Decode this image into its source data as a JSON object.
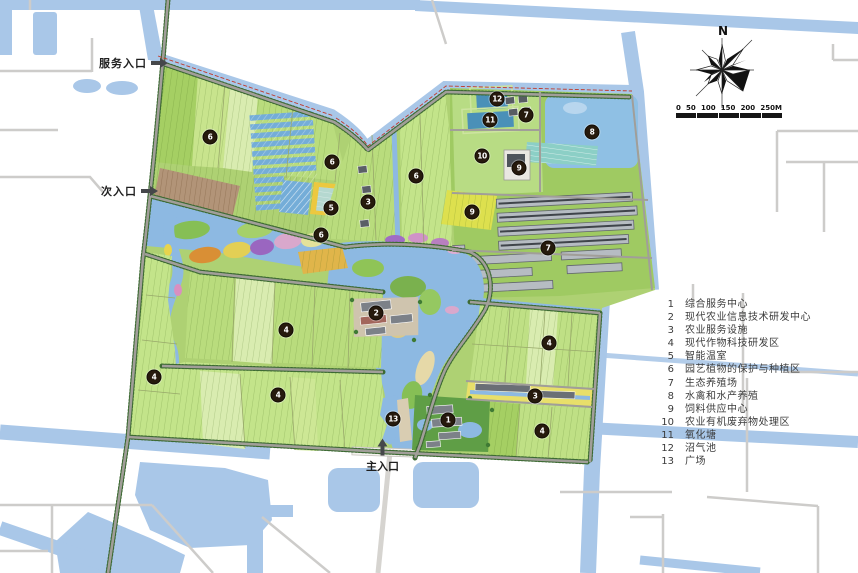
{
  "entrances": {
    "service": {
      "label": "服务入口"
    },
    "secondary": {
      "label": "次入口"
    },
    "main": {
      "label": "主入口"
    }
  },
  "compass": {
    "north_label": "N"
  },
  "scale_bar": {
    "labels": [
      "0",
      "50",
      "100",
      "150",
      "200",
      "250M"
    ]
  },
  "legend": {
    "items": [
      {
        "no": "1",
        "label": "综合服务中心"
      },
      {
        "no": "2",
        "label": "现代农业信息技术研发中心"
      },
      {
        "no": "3",
        "label": "农业服务设施"
      },
      {
        "no": "4",
        "label": "现代作物科技研发区"
      },
      {
        "no": "5",
        "label": "智能温室"
      },
      {
        "no": "6",
        "label": "园艺植物的保护与种植区"
      },
      {
        "no": "7",
        "label": "生态养殖场"
      },
      {
        "no": "8",
        "label": "水禽和水产养殖"
      },
      {
        "no": "9",
        "label": "饲料供应中心"
      },
      {
        "no": "10",
        "label": "农业有机废弃物处理区"
      },
      {
        "no": "11",
        "label": "氧化塘"
      },
      {
        "no": "12",
        "label": "沼气池"
      },
      {
        "no": "13",
        "label": "广场"
      }
    ]
  },
  "map": {
    "markers": [
      {
        "n": "6",
        "x": 210,
        "y": 137
      },
      {
        "n": "6",
        "x": 332,
        "y": 162
      },
      {
        "n": "6",
        "x": 416,
        "y": 176
      },
      {
        "n": "3",
        "x": 368,
        "y": 202
      },
      {
        "n": "5",
        "x": 331,
        "y": 208
      },
      {
        "n": "6",
        "x": 321,
        "y": 235
      },
      {
        "n": "12",
        "x": 497,
        "y": 99
      },
      {
        "n": "11",
        "x": 490,
        "y": 120
      },
      {
        "n": "7",
        "x": 526,
        "y": 115
      },
      {
        "n": "8",
        "x": 592,
        "y": 132
      },
      {
        "n": "10",
        "x": 482,
        "y": 156
      },
      {
        "n": "9",
        "x": 519,
        "y": 168
      },
      {
        "n": "9",
        "x": 472,
        "y": 212
      },
      {
        "n": "7",
        "x": 548,
        "y": 248
      },
      {
        "n": "2",
        "x": 376,
        "y": 313
      },
      {
        "n": "4",
        "x": 286,
        "y": 330
      },
      {
        "n": "4",
        "x": 154,
        "y": 377
      },
      {
        "n": "4",
        "x": 278,
        "y": 395
      },
      {
        "n": "13",
        "x": 393,
        "y": 419
      },
      {
        "n": "4",
        "x": 549,
        "y": 343
      },
      {
        "n": "3",
        "x": 535,
        "y": 396
      },
      {
        "n": "1",
        "x": 448,
        "y": 420
      },
      {
        "n": "4",
        "x": 542,
        "y": 431
      }
    ]
  },
  "colors": {
    "water": "#a9c7e8",
    "wetland": "#8db9e2",
    "field_green": "#b9dc7d",
    "accent_yellow": "#ecc83f",
    "marker_bg": "#261a0d",
    "road_gray": "#a19e99",
    "boundary_red": "#c0392b"
  }
}
